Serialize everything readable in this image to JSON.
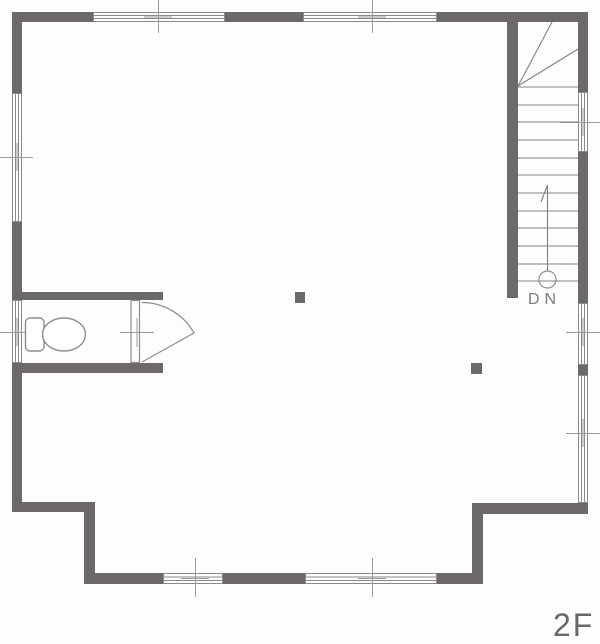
{
  "labels": {
    "floor": "2F",
    "stair_direction": "DN"
  },
  "plan": {
    "type": "architectural-floor-plan",
    "floor": "2F",
    "visible_features": [
      "staircase-down",
      "toilet",
      "swing-door",
      "sliding-windows",
      "structural-posts"
    ]
  },
  "colors": {
    "background": "#fdfdfd",
    "wall": "#6c6968",
    "window_line": "#8a8a8a",
    "fixture_line": "#8d8d8d",
    "tick": "#9c9c9c",
    "stair_line": "#818181",
    "dn_text": "#7c7c7c",
    "floor_text": "#696665"
  }
}
